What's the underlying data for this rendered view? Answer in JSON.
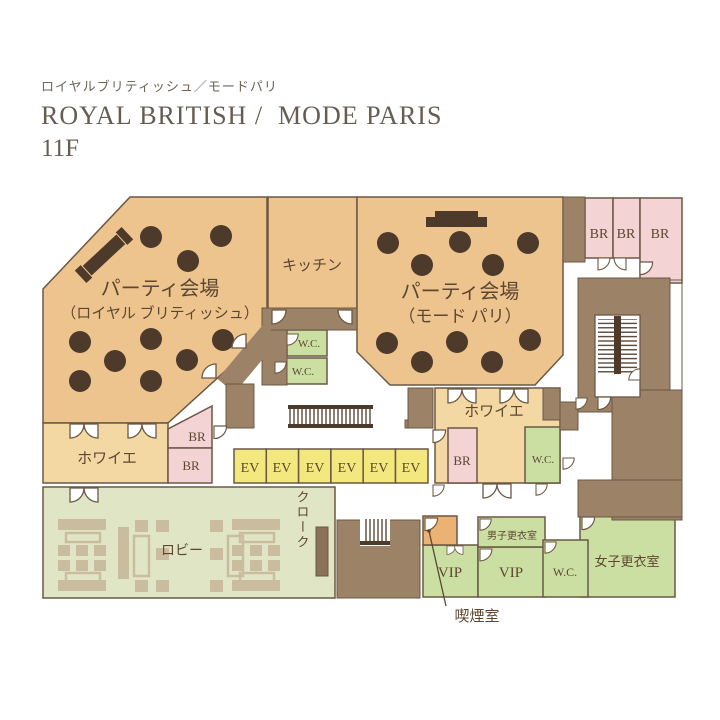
{
  "header": {
    "subtitle_jp": "ロイヤルブリティッシュ／モードパリ",
    "title": "ROYAL BRITISH /  MODE PARIS",
    "floor": "11F"
  },
  "rooms": {
    "party_royal_1": "パーティ会場",
    "party_royal_2": "（ロイヤル ブリティッシュ）",
    "party_mode_1": "パーティ会場",
    "party_mode_2": "（モード パリ）",
    "kitchen": "キッチン",
    "foyer": "ホワイエ",
    "wc": "W.C.",
    "br": "BR",
    "ev": "EV",
    "lobby": "ロビー",
    "cloak": "クローク",
    "vip": "VIP",
    "mens_changing": "男子更衣室",
    "womens_changing": "女子更衣室",
    "smoking": "喫煙室"
  },
  "colors": {
    "hall": "#EEC48E",
    "foyer": "#F4D8A4",
    "banquet_room_pink": "#F4D3D5",
    "service_green": "#CCDFA2",
    "lobby_green": "#E0E6C5",
    "elevator_yellow": "#F2E87D",
    "wall_brown": "#9C8266",
    "table_dark": "#4E3A2A",
    "smoking_orange": "#EBB274",
    "text": "#5C4731"
  }
}
